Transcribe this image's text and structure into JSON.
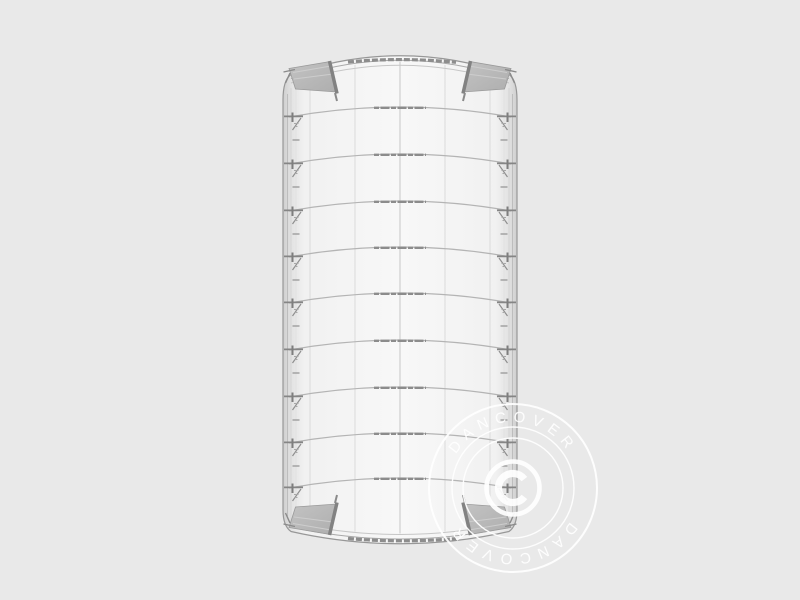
{
  "drawing": {
    "title": "tent-frame-top-view",
    "rib_y": [
      107,
      154,
      201,
      247,
      293,
      340,
      387,
      433,
      478
    ],
    "seam_x": [
      310,
      355,
      400,
      445,
      490
    ],
    "frame": {
      "left": 283,
      "right": 517,
      "ridge_end_y": 74.5,
      "ridge_peak_y": 53,
      "beam_end_y": 531.5,
      "beam_center_y": 544
    },
    "colors": {
      "background": "#e9e9e9",
      "frame_line": "#979797",
      "inner_line": "#c6c6c6",
      "seam_line": "#dadada",
      "seam_center": "#cfcfcf",
      "rib_line": "#b4b4b4",
      "rib_bold": "#8c8c8c",
      "band_dark": "#8d8d8d",
      "fitting_dark": "#7e7e7e",
      "fitting_mid": "#8f8f8f",
      "fitting_light": "#a8a8a8",
      "mid_tick": "#9e9e9e",
      "panel_fill": "#b7b7b7",
      "panel_streak": "#cdcdcd",
      "panel_bar": "#828282",
      "body_edge": "#cfcfcf",
      "body_center": "#f8f8f8"
    }
  },
  "watermark": {
    "brand": "DANCOVER",
    "symbol": "©",
    "color": "#ffffff",
    "center_x": 513,
    "center_y": 488,
    "outer_radius": 84
  }
}
